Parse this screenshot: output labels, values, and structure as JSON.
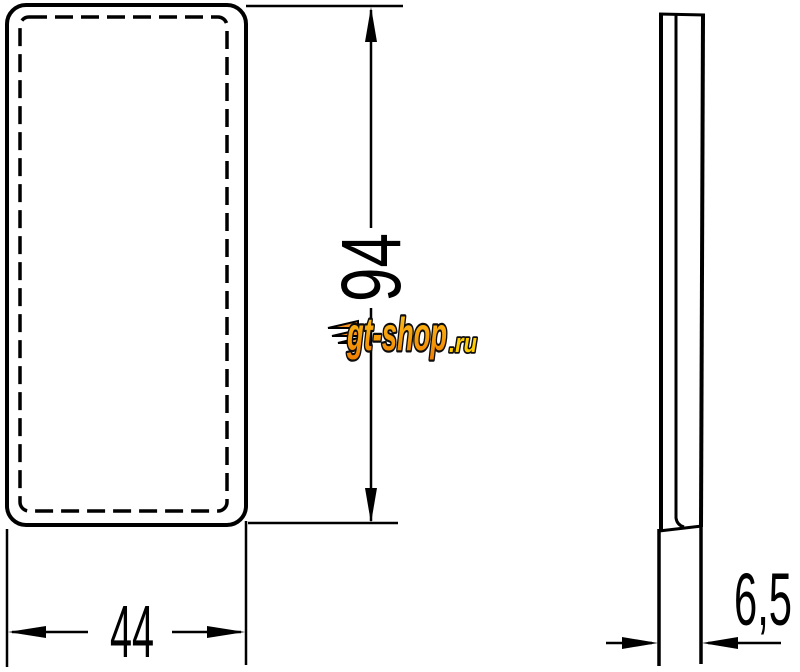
{
  "canvas": {
    "background": "#ffffff",
    "line_color": "#000000"
  },
  "front_view": {
    "height_label": "94",
    "width_label": "44"
  },
  "side_view": {
    "depth_label": "6,5"
  },
  "watermark": {
    "text": "gt-shop",
    "suffix": ".ru",
    "fill_top": "#ffc61a",
    "fill_bottom": "#f07f00",
    "suffix_fill": "#ffcc00",
    "outline": "#0d0d0d"
  }
}
